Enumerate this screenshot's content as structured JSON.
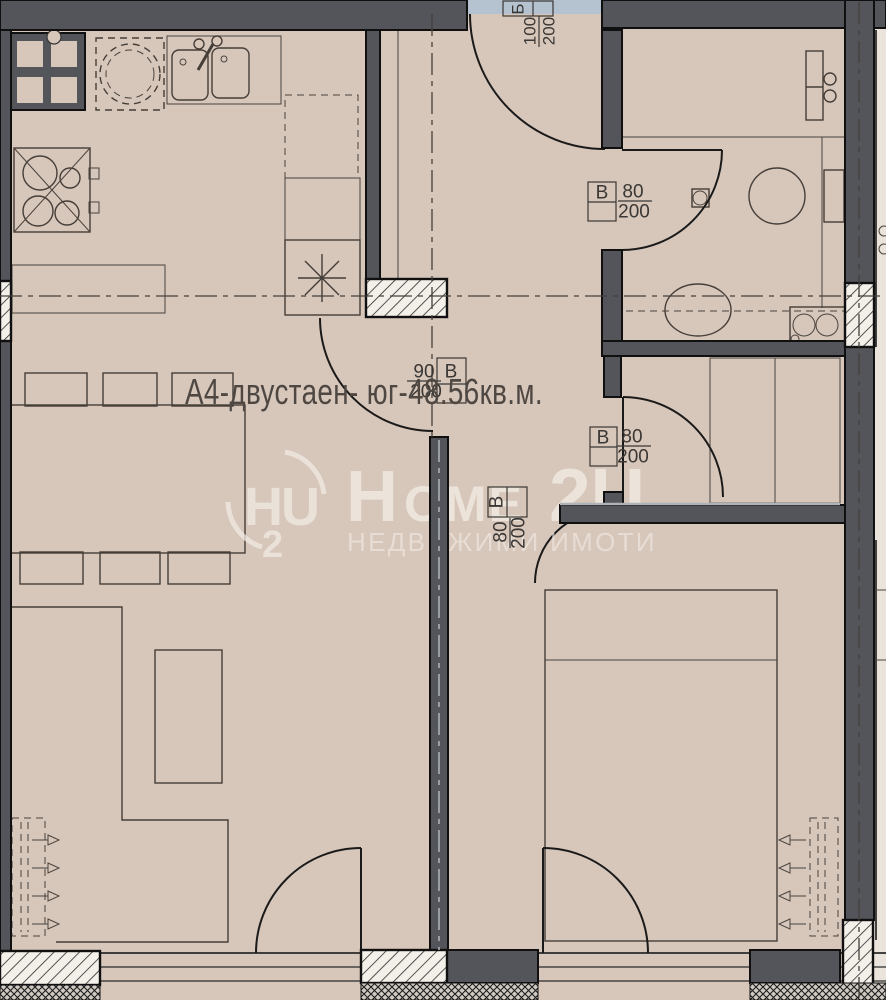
{
  "title": "А4-двустаен- юг-48.56кв.м.",
  "watermark": {
    "logo_letters": "HU",
    "logo_number": "2",
    "brand_h": "H",
    "brand_mid": "OME",
    "brand_end": "2U",
    "tagline": "НЕДВИЖИМИ ИМОТИ"
  },
  "door_labels": {
    "entry": {
      "letter": "Б",
      "width": "100",
      "height": "200"
    },
    "bathroom": {
      "letter": "В",
      "width": "80",
      "height": "200"
    },
    "kitchen": {
      "letter": "В",
      "width": "90",
      "height": "200"
    },
    "bedroom": {
      "letter": "В",
      "width": "80",
      "height": "200"
    },
    "living": {
      "letter": "В",
      "width": "80",
      "height": "200"
    }
  },
  "colors": {
    "floor": "#d7c6ba",
    "wall": "#54555a",
    "corridor_strip": "#b5c2cf",
    "neighbor_floor": "#ebe4dc",
    "line": "#1a1a1a",
    "watermark": "#f2ece5",
    "label_text": "#3a3734"
  }
}
